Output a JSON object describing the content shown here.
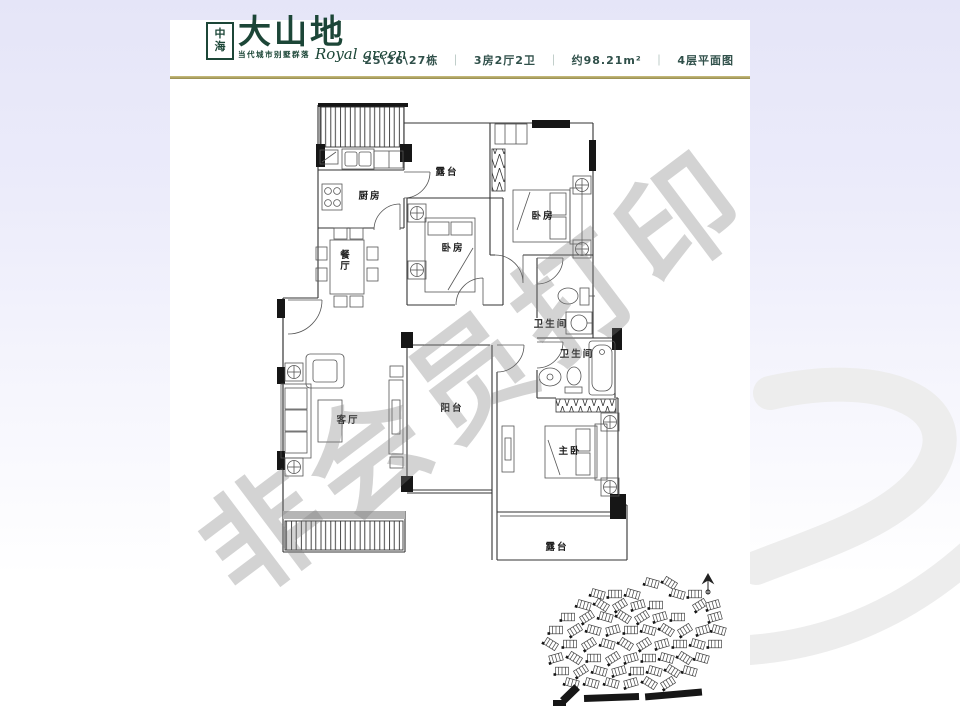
{
  "brand": {
    "logo_box": "中海",
    "logo_name": "大山地",
    "logo_tagline": "当代城市别墅群落",
    "logo_script": "Royal green",
    "color": "#1c4637"
  },
  "header": {
    "building": "25\\26\\27栋",
    "unit_layout": "3房2厅2卫",
    "area": "约98.21m²",
    "floor_plan": "4层平面图",
    "divider": "｜",
    "rule_color": "#a89c58"
  },
  "watermark": {
    "text": "非会员打印"
  },
  "floorplan": {
    "rooms": [
      {
        "id": "terrace-top",
        "label": "露台",
        "x": 447,
        "y": 175
      },
      {
        "id": "kitchen",
        "label": "厨房",
        "x": 370,
        "y": 199
      },
      {
        "id": "bedroom-right",
        "label": "卧房",
        "x": 543,
        "y": 219
      },
      {
        "id": "bedroom-middle",
        "label": "卧房",
        "x": 453,
        "y": 251
      },
      {
        "id": "dining-room",
        "label": "餐厅",
        "x": 346,
        "y": 258,
        "vertical": true
      },
      {
        "id": "bathroom-upper",
        "label": "卫生间",
        "x": 551,
        "y": 327
      },
      {
        "id": "bathroom-lower",
        "label": "卫生间",
        "x": 577,
        "y": 357
      },
      {
        "id": "living-room",
        "label": "客厅",
        "x": 348,
        "y": 423
      },
      {
        "id": "balcony",
        "label": "阳台",
        "x": 452,
        "y": 411
      },
      {
        "id": "master-bedroom",
        "label": "主卧",
        "x": 570,
        "y": 454
      },
      {
        "id": "terrace-bottom",
        "label": "露台",
        "x": 557,
        "y": 550
      }
    ]
  },
  "colors": {
    "plan_line": "#333333",
    "accent_green": "#1c4637",
    "swirl": "#ededed"
  }
}
